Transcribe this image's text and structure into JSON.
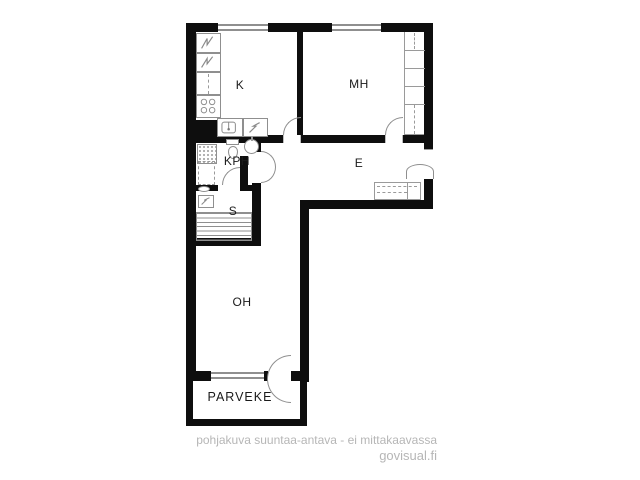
{
  "rooms": {
    "kitchen": {
      "label": "K"
    },
    "bedroom": {
      "label": "MH"
    },
    "bathroom": {
      "label": "KPH"
    },
    "entry": {
      "label": "E"
    },
    "sauna": {
      "label": "S"
    },
    "living": {
      "label": "OH"
    },
    "balcony": {
      "label": "PARVEKE"
    }
  },
  "footer": {
    "disclaimer": "pohjakuva suuntaa-antava - ei mittakaavassa",
    "brand": "govisual.fi"
  },
  "colors": {
    "background": "#ffffff",
    "wall": "#0e0e0e",
    "fixture_line": "#8f8f8f",
    "label_text": "#1a1a1a",
    "footer_text": "#b6b6b6"
  },
  "icons": [
    "fridge-freezer-icon",
    "cabinet-icon",
    "stove-icon",
    "sink-icon",
    "dishwasher-icon",
    "shower-area-icon",
    "toilet-icon",
    "washbasin-icon",
    "washer-reservation-icon",
    "floor-drain-icon",
    "sauna-heater-icon",
    "sauna-benches-icon",
    "wardrobe-icon",
    "closet-icon",
    "door-arc-icon",
    "window-icon"
  ]
}
